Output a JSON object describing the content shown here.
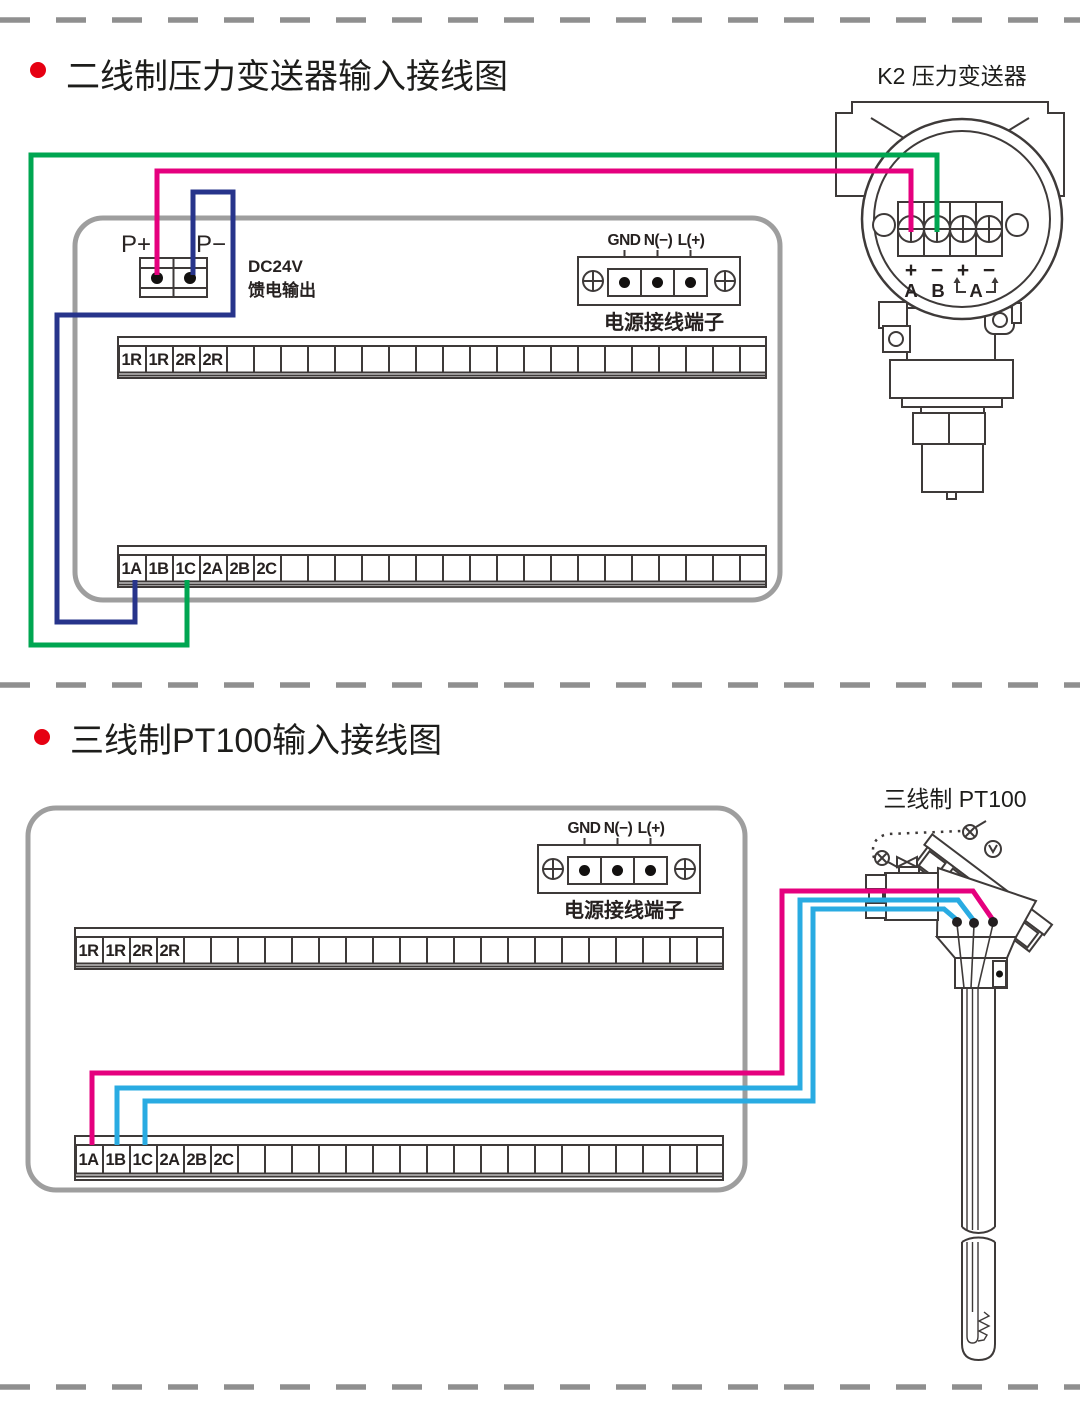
{
  "colors": {
    "wire_pink": "#e5007e",
    "wire_green": "#00a651",
    "wire_blue": "#27348b",
    "wire_cyan": "#29abe2",
    "box_gray": "#9e9e9e",
    "dash_gray": "#8f8f8f",
    "bullet_red": "#e60012",
    "line_art": "#3e3a39"
  },
  "section1": {
    "title": "二线制压力变送器输入接线图",
    "device_label": "K2  压力变送器",
    "feed": {
      "p_plus": "P+",
      "p_minus": "P−",
      "line1": "DC24V",
      "line2": "馈电输出"
    },
    "power": {
      "gnd": "GND",
      "n": "N(−)",
      "l": "L(+)",
      "caption": "电源接线端子"
    },
    "strip_top": [
      "1R",
      "1R",
      "2R",
      "2R"
    ],
    "strip_bottom": [
      "1A",
      "1B",
      "1C",
      "2A",
      "2B",
      "2C"
    ],
    "transmitter": {
      "signs": [
        "+",
        "−",
        "+",
        "−"
      ],
      "letters": [
        "A",
        "B"
      ],
      "span_letter": "A"
    }
  },
  "section2": {
    "title": "三线制PT100输入接线图",
    "device_label": "三线制  PT100",
    "power": {
      "gnd": "GND",
      "n": "N(−)",
      "l": "L(+)",
      "caption": "电源接线端子"
    },
    "strip_top": [
      "1R",
      "1R",
      "2R",
      "2R"
    ],
    "strip_bottom": [
      "1A",
      "1B",
      "1C",
      "2A",
      "2B",
      "2C"
    ]
  }
}
